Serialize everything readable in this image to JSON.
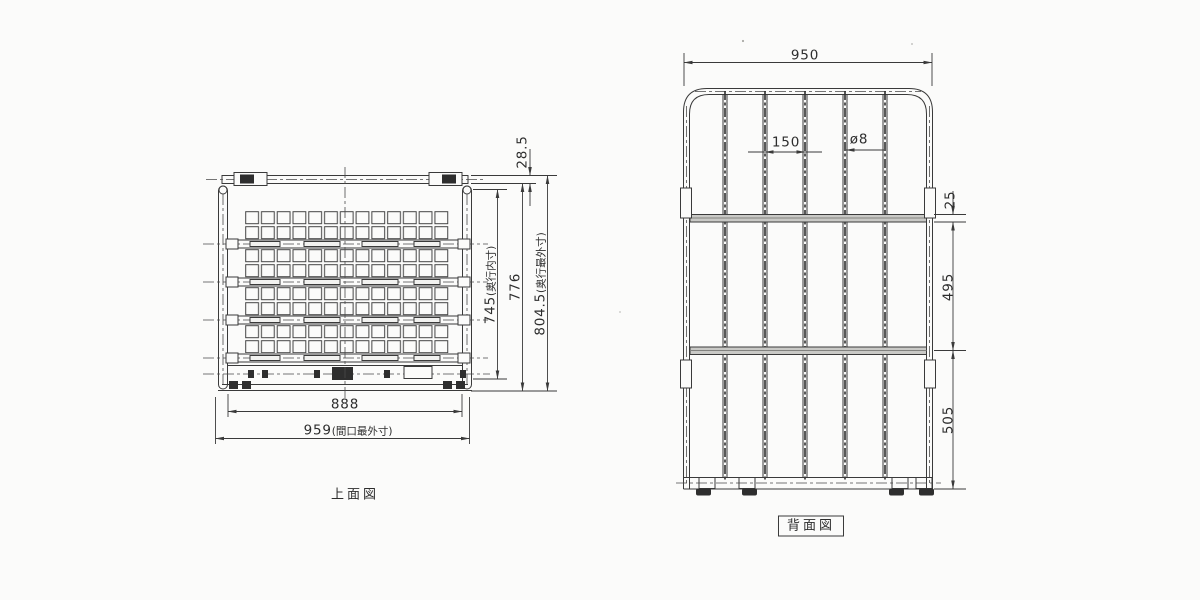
{
  "meta": {
    "background": "#fbfbfa",
    "ink_color": "#3a3a3a"
  },
  "top_view": {
    "label": "上面図",
    "dims": {
      "inner_width": "888",
      "outer_width": {
        "num": "959",
        "note": "(間口最外寸)"
      },
      "inner_depth": {
        "num": "745",
        "note": "(奥行内寸)"
      },
      "mid_depth": "776",
      "outer_depth": {
        "num": "804.5",
        "note": "(奥行最外寸)"
      },
      "top_offset": "28.5"
    },
    "grid": {
      "rows": 8,
      "cols": 13,
      "bands": 4,
      "cross_bars": 4
    }
  },
  "rear_view": {
    "label": "背面図",
    "dims": {
      "width": "950",
      "bar_pitch": "150",
      "bar_diameter": "ø8",
      "bar_thickness": "25",
      "upper_span": "495",
      "lower_span": "505"
    },
    "vertical_bar_count": 5,
    "horizontal_bar_count": 2
  }
}
